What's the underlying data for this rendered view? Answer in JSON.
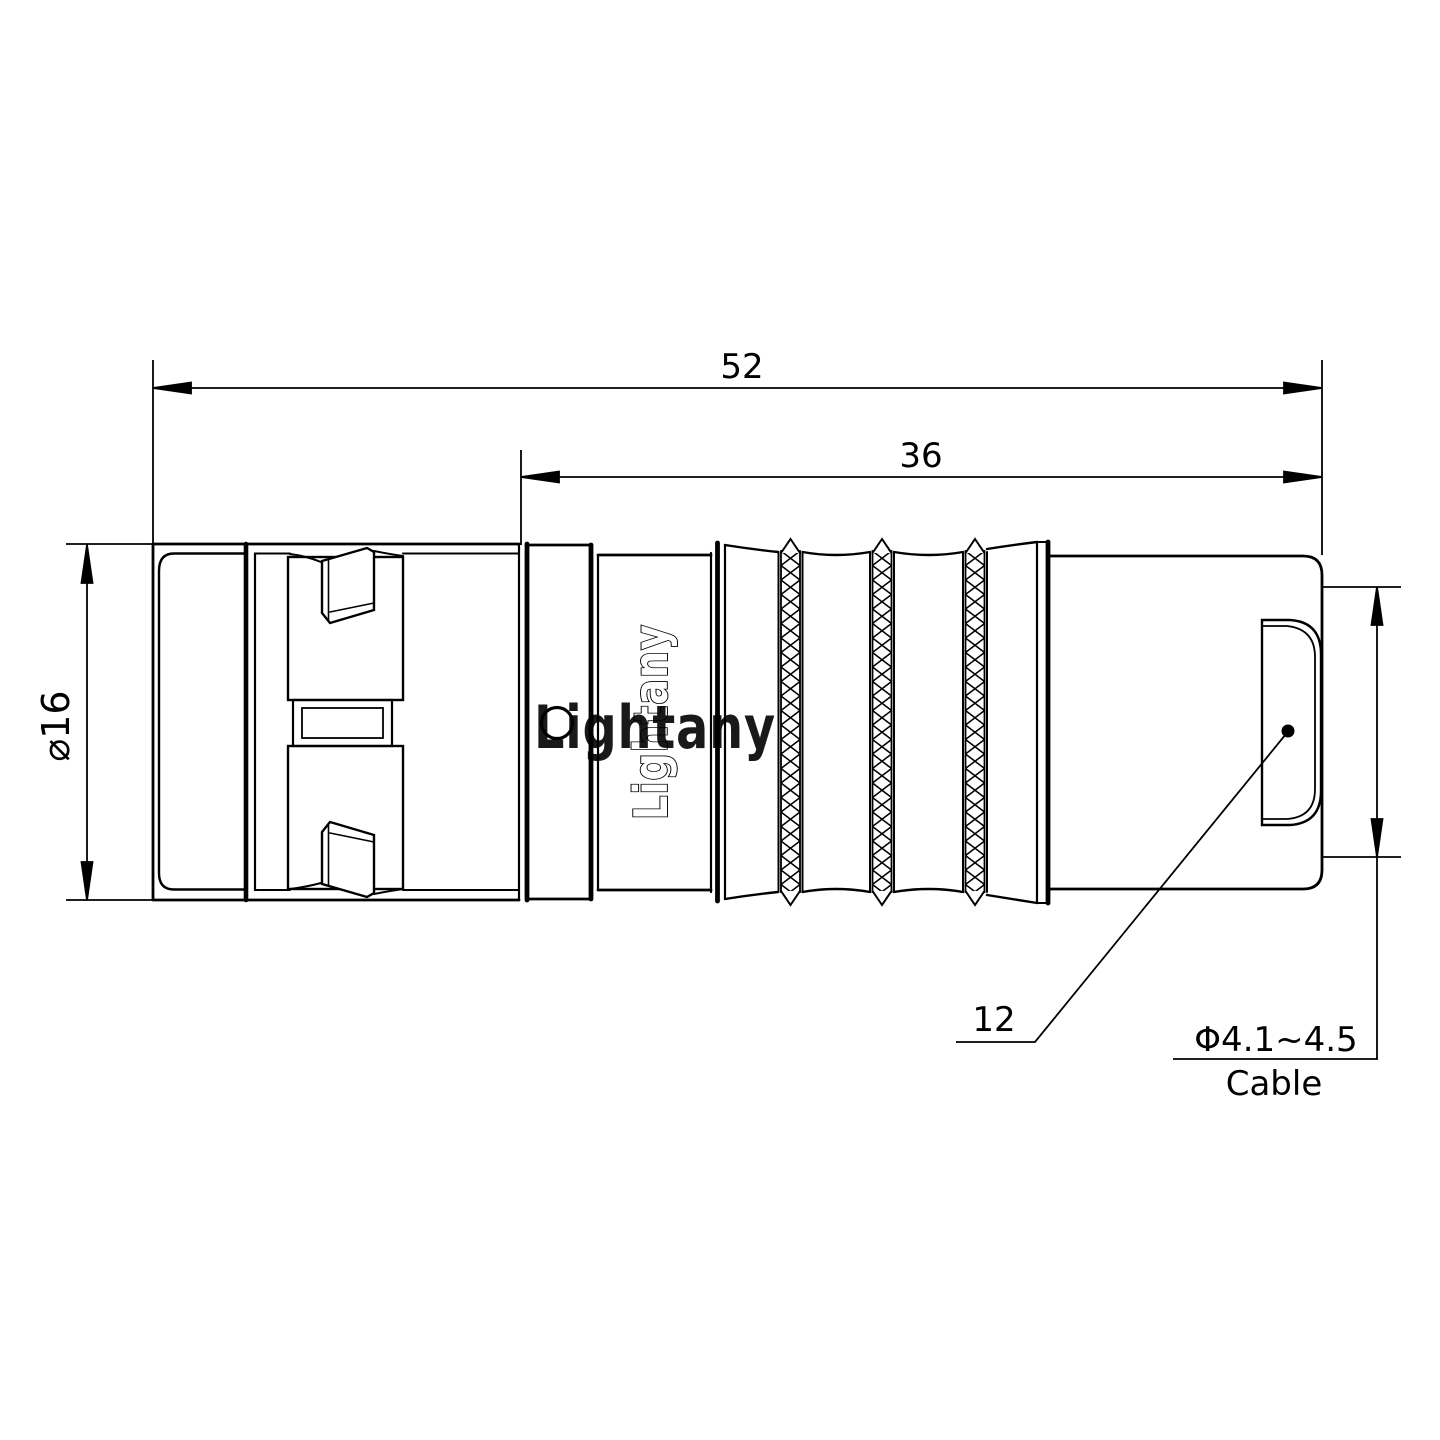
{
  "page": {
    "background": "#ffffff",
    "line_color": "#000000",
    "watermark_color": "#efabb0"
  },
  "dimensions": {
    "total_length": "52",
    "front_length": "36",
    "diameter": "⌀16",
    "boot_length": "12",
    "cable_range": "Φ4.1~4.5",
    "cable_label": "Cable"
  },
  "branding": {
    "engraved_logo": "Lightany",
    "watermark": "Lightany"
  }
}
